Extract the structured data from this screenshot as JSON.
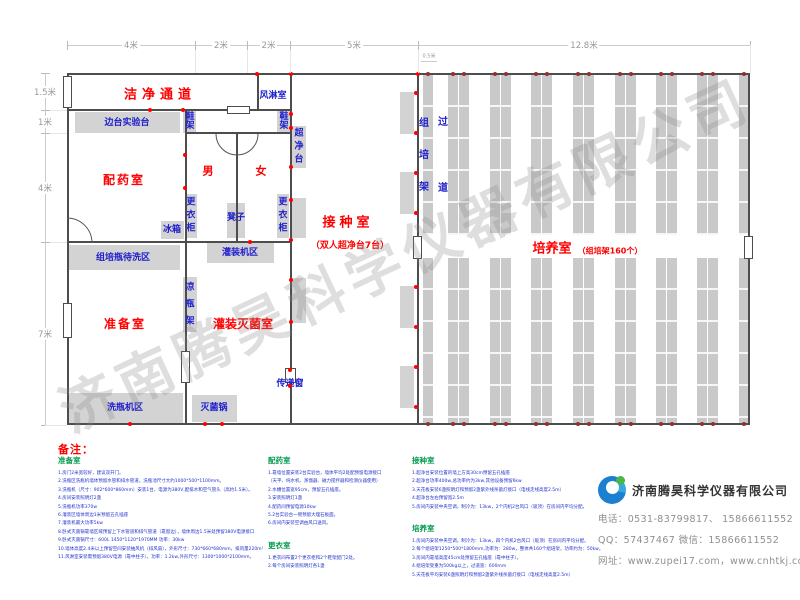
{
  "watermark_text": "济南腾昊科学仪器有限公司",
  "colors": {
    "red": "#ff0000",
    "blue": "#2020cc",
    "green": "#009a4e",
    "wall": "#4d4d4d",
    "gray_fill": "#d3d3d3",
    "note_blue": "#2233cc",
    "dim_gray": "#999999",
    "dot_red": "#ff0000"
  },
  "plan": {
    "walls": [
      {
        "x": 67,
        "y": 73,
        "w": 683,
        "h": 2
      },
      {
        "x": 67,
        "y": 423,
        "w": 683,
        "h": 2
      },
      {
        "x": 67,
        "y": 73,
        "w": 2,
        "h": 352
      },
      {
        "x": 748,
        "y": 73,
        "w": 2,
        "h": 352
      },
      {
        "x": 67,
        "y": 109,
        "w": 225,
        "h": 2
      },
      {
        "x": 185,
        "y": 132,
        "w": 107,
        "h": 2
      },
      {
        "x": 257,
        "y": 73,
        "w": 2,
        "h": 38
      },
      {
        "x": 185,
        "y": 109,
        "w": 2,
        "h": 316
      },
      {
        "x": 236,
        "y": 132,
        "w": 2,
        "h": 111
      },
      {
        "x": 290,
        "y": 73,
        "w": 2,
        "h": 352
      },
      {
        "x": 67,
        "y": 241,
        "w": 225,
        "h": 2
      },
      {
        "x": 417,
        "y": 73,
        "w": 2,
        "h": 352
      }
    ],
    "windows": [
      {
        "x": 63,
        "y": 76,
        "w": 9,
        "h": 32
      },
      {
        "x": 63,
        "y": 303,
        "w": 9,
        "h": 35
      },
      {
        "x": 181,
        "y": 351,
        "w": 9,
        "h": 32
      },
      {
        "x": 413,
        "y": 236,
        "w": 9,
        "h": 23
      },
      {
        "x": 744,
        "y": 236,
        "w": 9,
        "h": 23
      },
      {
        "x": 227,
        "y": 106,
        "w": 23,
        "h": 8
      },
      {
        "x": 285,
        "y": 368,
        "w": 11,
        "h": 15
      }
    ],
    "arcs": [
      "M 92 243 A 25 25 0 0 0 67 218",
      "M 216 134 A 21 21 0 0 0 258 134"
    ],
    "areas": [
      {
        "x": 75,
        "y": 112,
        "w": 105,
        "h": 21
      },
      {
        "x": 183,
        "y": 111,
        "w": 13,
        "h": 22
      },
      {
        "x": 277,
        "y": 111,
        "w": 13,
        "h": 22
      },
      {
        "x": 292,
        "y": 126,
        "w": 14,
        "h": 42
      },
      {
        "x": 185,
        "y": 194,
        "w": 12,
        "h": 44
      },
      {
        "x": 227,
        "y": 203,
        "w": 18,
        "h": 35
      },
      {
        "x": 277,
        "y": 194,
        "w": 12,
        "h": 44
      },
      {
        "x": 161,
        "y": 221,
        "w": 23,
        "h": 18
      },
      {
        "x": 68,
        "y": 245,
        "w": 112,
        "h": 25
      },
      {
        "x": 207,
        "y": 243,
        "w": 67,
        "h": 20
      },
      {
        "x": 183,
        "y": 277,
        "w": 14,
        "h": 55
      },
      {
        "x": 68,
        "y": 393,
        "w": 115,
        "h": 30
      },
      {
        "x": 192,
        "y": 395,
        "w": 45,
        "h": 27
      },
      {
        "x": 292,
        "y": 198,
        "w": 14,
        "h": 40
      },
      {
        "x": 290,
        "y": 278,
        "w": 16,
        "h": 45
      },
      {
        "x": 400,
        "y": 92,
        "w": 14,
        "h": 42
      },
      {
        "x": 400,
        "y": 172,
        "w": 14,
        "h": 42
      },
      {
        "x": 400,
        "y": 286,
        "w": 14,
        "h": 42
      },
      {
        "x": 400,
        "y": 366,
        "w": 14,
        "h": 42
      }
    ],
    "labels": [
      {
        "t": "洁净通道",
        "cx": 160,
        "cy": 96,
        "c": "red",
        "s": 13,
        "b": 1,
        "ls": 5
      },
      {
        "t": "风淋室",
        "cx": 273,
        "cy": 96,
        "c": "blue",
        "s": 9,
        "b": 1
      },
      {
        "t": "边台实验台",
        "cx": 127,
        "cy": 123,
        "c": "blue",
        "s": 9,
        "b": 1
      },
      {
        "t": "鞋架",
        "cx": 190,
        "cy": 122,
        "c": "blue",
        "s": 9,
        "b": 1,
        "v": 1,
        "gap": 0
      },
      {
        "t": "鞋架",
        "cx": 284,
        "cy": 122,
        "c": "blue",
        "s": 9,
        "b": 1,
        "v": 1,
        "gap": 0
      },
      {
        "t": "超净台",
        "cx": 299,
        "cy": 147,
        "c": "blue",
        "s": 9,
        "b": 1,
        "v": 1,
        "gap": 4
      },
      {
        "t": "配药室",
        "cx": 124,
        "cy": 181,
        "c": "red",
        "s": 12,
        "b": 1,
        "ls": 2
      },
      {
        "t": "男",
        "cx": 208,
        "cy": 172,
        "c": "red",
        "s": 11,
        "b": 1
      },
      {
        "t": "女",
        "cx": 261,
        "cy": 172,
        "c": "red",
        "s": 11,
        "b": 1
      },
      {
        "t": "更衣柜",
        "cx": 191,
        "cy": 216,
        "c": "blue",
        "s": 9,
        "b": 1,
        "v": 1,
        "gap": 4
      },
      {
        "t": "凳子",
        "cx": 236,
        "cy": 218,
        "c": "blue",
        "s": 9,
        "b": 1
      },
      {
        "t": "更衣柜",
        "cx": 283,
        "cy": 216,
        "c": "blue",
        "s": 9,
        "b": 1,
        "v": 1,
        "gap": 4
      },
      {
        "t": "冰箱",
        "cx": 172,
        "cy": 230,
        "c": "blue",
        "s": 9,
        "b": 1
      },
      {
        "t": "组培瓶待洗区",
        "cx": 123,
        "cy": 258,
        "c": "blue",
        "s": 9,
        "b": 1
      },
      {
        "t": "灌装机区",
        "cx": 240,
        "cy": 253,
        "c": "blue",
        "s": 9,
        "b": 1
      },
      {
        "t": "凉瓶架",
        "cx": 190,
        "cy": 305,
        "c": "blue",
        "s": 9,
        "b": 1,
        "v": 1,
        "gap": 8
      },
      {
        "t": "准备室",
        "cx": 125,
        "cy": 325,
        "c": "red",
        "s": 12,
        "b": 1,
        "ls": 2
      },
      {
        "t": "灌装灭菌室",
        "cx": 243,
        "cy": 325,
        "c": "red",
        "s": 12,
        "b": 1
      },
      {
        "t": "洗瓶机区",
        "cx": 125,
        "cy": 408,
        "c": "blue",
        "s": 9,
        "b": 1
      },
      {
        "t": "灭菌锅",
        "cx": 214,
        "cy": 408,
        "c": "blue",
        "s": 9,
        "b": 1
      },
      {
        "t": "传递窗",
        "cx": 290,
        "cy": 384,
        "c": "blue",
        "s": 9,
        "b": 1
      },
      {
        "t": "接种室",
        "cx": 348,
        "cy": 224,
        "c": "red",
        "s": 13,
        "b": 1,
        "ls": 4
      },
      {
        "t": "（双人超净台7台）",
        "cx": 350,
        "cy": 246,
        "c": "red",
        "s": 9,
        "b": 1
      },
      {
        "t": "培养室",
        "cx": 552,
        "cy": 250,
        "c": "red",
        "s": 13,
        "b": 1
      },
      {
        "t": "（组培架160个）",
        "cx": 610,
        "cy": 251,
        "c": "red",
        "s": 8,
        "b": 1
      },
      {
        "t": "组培架",
        "cx": 424,
        "cy": 156,
        "c": "blue",
        "s": 10,
        "b": 1,
        "v": 1,
        "gap": 22
      },
      {
        "t": "过道",
        "cx": 443,
        "cy": 156,
        "c": "blue",
        "s": 10,
        "b": 1,
        "v": 1,
        "gap": 56
      }
    ],
    "shelves": {
      "cols": [
        423,
        448,
        459,
        490,
        501,
        531,
        542,
        573,
        584,
        615,
        626,
        656,
        667,
        697,
        708,
        739
      ],
      "w": 10,
      "top": {
        "y": 75,
        "h": 160
      },
      "bottom": {
        "y": 258,
        "h": 165
      }
    },
    "extra_dots": [
      [
        150,
        110
      ],
      [
        183,
        110
      ],
      [
        257,
        74
      ],
      [
        291,
        74
      ],
      [
        418,
        74
      ],
      [
        185,
        155
      ],
      [
        185,
        188
      ],
      [
        250,
        242
      ],
      [
        291,
        114
      ],
      [
        291,
        128
      ],
      [
        291,
        167
      ],
      [
        291,
        200
      ],
      [
        291,
        240
      ],
      [
        291,
        280
      ],
      [
        291,
        322
      ],
      [
        416,
        93
      ],
      [
        416,
        133
      ],
      [
        416,
        173
      ],
      [
        416,
        213
      ],
      [
        416,
        287
      ],
      [
        416,
        327
      ],
      [
        416,
        367
      ],
      [
        416,
        407
      ],
      [
        290,
        370
      ],
      [
        290,
        386
      ],
      [
        130,
        424
      ],
      [
        205,
        424
      ],
      [
        222,
        424
      ]
    ],
    "dims": {
      "top_y": 45,
      "top": [
        {
          "label": "4米",
          "x1": 67,
          "x2": 195
        },
        {
          "label": "2米",
          "x1": 195,
          "x2": 247
        },
        {
          "label": "2米",
          "x1": 247,
          "x2": 290
        },
        {
          "label": "5米",
          "x1": 290,
          "x2": 418
        },
        {
          "label": "12.8米",
          "x1": 418,
          "x2": 750
        }
      ],
      "left_x": 45,
      "left": [
        {
          "label": "1.5米",
          "y1": 73,
          "y2": 110
        },
        {
          "label": "1米",
          "y1": 110,
          "y2": 133
        },
        {
          "label": "4米",
          "y1": 133,
          "y2": 242
        },
        {
          "label": "7米",
          "y1": 242,
          "y2": 425
        }
      ],
      "mini": {
        "label": "0.5米",
        "x1": 421,
        "x2": 437,
        "y": 61
      }
    }
  },
  "notes": {
    "heading": "备注：",
    "columns": [
      {
        "x": 58,
        "w": 205,
        "sections": [
          {
            "title": "准备室",
            "items": [
              "1.房门2米宽较好，建议双开门。",
              "2.洗瓶区洗瓶机墙体预留水管和排水管道，洗瓶池尺寸大约1000*500*1100mm。",
              "3.洗瓶机（尺寸：902*600*860mm）安装1台，电源为380V,配排水和空气管头（高约1.5米）。",
              "4.房间安装照明灯2盏",
              "5.洗瓶机功率370w",
              "6.灌装区墙体周边1米预留五孔插座",
              "7.灌装机最大功率5kw",
              "8.卧式灭菌锅靠墙区域预留上下水管道和排气管道（靠窗边），墙体周边1.5米处预留380V电源接口",
              "9.卧式灭菌锅尺寸：600L  1450*1120*1970MM  功率：30kw",
              "10.墙体高度2.4米以上预留空间安装抽风机（排风扇），外形尺寸：730*660*680mm，排风量220m³/min，五孔插座（靠中柱子）",
              "11.风淋室安装需预留380V电源（靠中柱子）。功率：1.2kw,外形尺寸：1300*1000*2100mm。"
            ]
          }
        ]
      },
      {
        "x": 268,
        "w": 140,
        "sections": [
          {
            "title": "配药室",
            "items": [
              "1.靠墙位置安装2台实验台，墙体平均2处配预留电源接口",
              "（天平、纯水机、蒸馏器、磁力搅拌器和检测仪器使用）",
              "2.水槽位置宽95cm，预留五孔插座。",
              "3.安装照明灯1盏",
              "4.配药间预留电源10kw",
              "5.2台实验台一侧预留大理石板面。",
              "6.房间内安装空调由风口送风。"
            ]
          },
          {
            "title": "更衣室",
            "items": [
              "1.更衣间布置2个更衣柜和2个鞋架配门2处。",
              "2.每个房间安装照明灯各1盏"
            ]
          }
        ]
      },
      {
        "x": 412,
        "w": 355,
        "sections": [
          {
            "title": "接种室",
            "items": [
              "1.超净台安装位置的墙上方高30cm预留五孔插座",
              "2.超净台功率400w,总功率约为3kw,其他设备预留6kw",
              "3.天花板安装6盏照明灯和预留2盏紫外线杀菌灯接口（电线走线高度2.5m）",
              "4.超净台左右预留宽2.5m",
              "5.房间内安装中央空调，制冷为：13kw，2个内机2台风口（吸顶）在房间内平均分配。"
            ]
          },
          {
            "title": "培养室",
            "items": [
              "1.房间内安装中央空调，制冷为：13kw，四个内机2台风口（吸顶）在房间内平均分配。",
              "2.每个组培架1250*500*1800mm,功率为：280w，整体共160个组培架，功率约为：50kw。",
              "3.房间内靠墙高度45cm处预留五孔插座（靠中柱子）。",
              "4.组培架受重为500kg以上，过道宽：600mm",
              "5.天花板平均安装6盏照明灯和预留2盏紫外线杀菌灯接口（电线走线高度2.5m）"
            ]
          }
        ]
      }
    ]
  },
  "company": {
    "name": "济南腾昊科学仪器有限公司",
    "phone": "电话：0531-83799817、 15866611552",
    "qq": "QQ：57437467    微信：15866611552",
    "website": "网址：www.zupei17.com，www.cnhtkj.com"
  }
}
